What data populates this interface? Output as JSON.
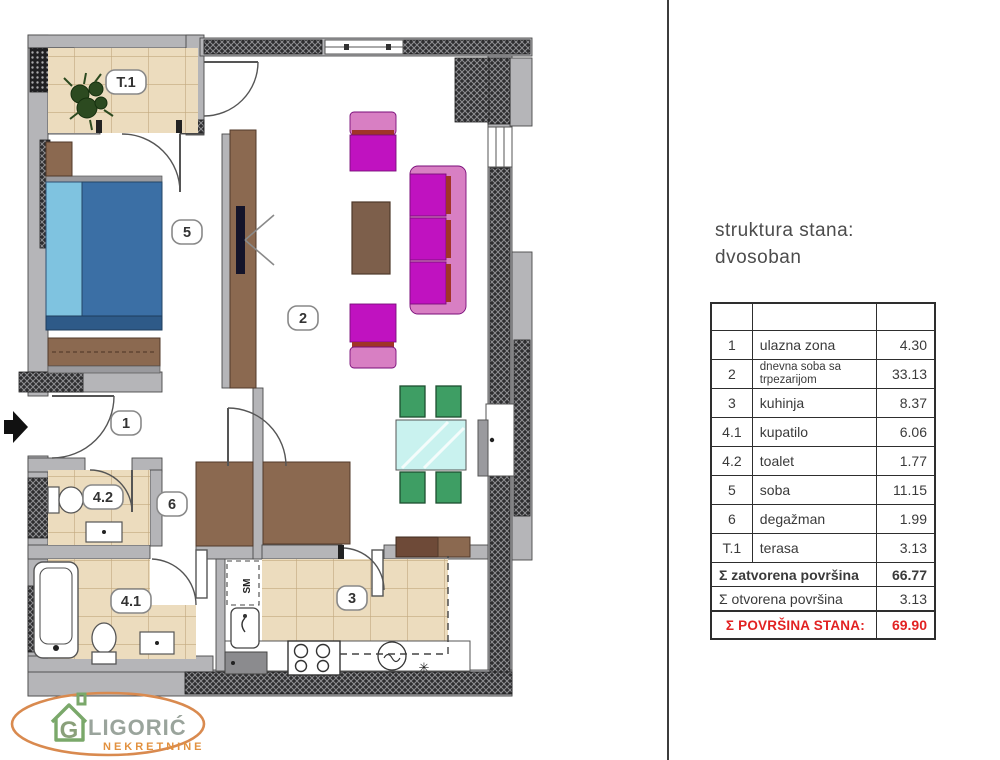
{
  "title": {
    "line1": "struktura stana:",
    "line2": "dvosoban"
  },
  "area_table": {
    "rows": [
      {
        "num": "1",
        "name": "ulazna zona",
        "area": "4.30"
      },
      {
        "num": "2",
        "name": "dnevna soba sa trpezarijom",
        "area": "33.13"
      },
      {
        "num": "3",
        "name": "kuhinja",
        "area": "8.37"
      },
      {
        "num": "4.1",
        "name": "kupatilo",
        "area": "6.06"
      },
      {
        "num": "4.2",
        "name": "toalet",
        "area": "1.77"
      },
      {
        "num": "5",
        "name": "soba",
        "area": "11.15"
      },
      {
        "num": "6",
        "name": "degažman",
        "area": "1.99"
      },
      {
        "num": "T.1",
        "name": "terasa",
        "area": "3.13"
      }
    ],
    "summary_closed": {
      "name": "Σ zatvorena površina",
      "area": "66.77"
    },
    "summary_open": {
      "name": "Σ otvorena površina",
      "area": "3.13"
    },
    "summary_total": {
      "name": "Σ POVRŠINA STANA:",
      "area": "69.90"
    }
  },
  "plan": {
    "labels": {
      "t1": "T.1",
      "r5": "5",
      "r2": "2",
      "r1": "1",
      "r42": "4.2",
      "r6": "6",
      "r41": "4.1",
      "r3": "3"
    },
    "annotations": {
      "washing_machine": "SM",
      "freezer": "✳"
    },
    "colors": {
      "wall_gray": "#b5b5b8",
      "wall_dark": "#2e2e30",
      "tile": "#ecdcbe",
      "bed_blue": "#3b6fa5",
      "pillow_blue": "#7fc3e0",
      "furniture_brown": "#8b6950",
      "sofa_magenta": "#c012c0",
      "sofa_pink": "#d87fc3",
      "sofa_stripe": "#a03428",
      "table_cyan": "#c9f2ef",
      "chair_green": "#3e9e64",
      "total_red": "#e22222"
    }
  },
  "logo": {
    "monogram": "G",
    "name": "LIGORIĆ",
    "sub": "NEKRETNINE"
  }
}
